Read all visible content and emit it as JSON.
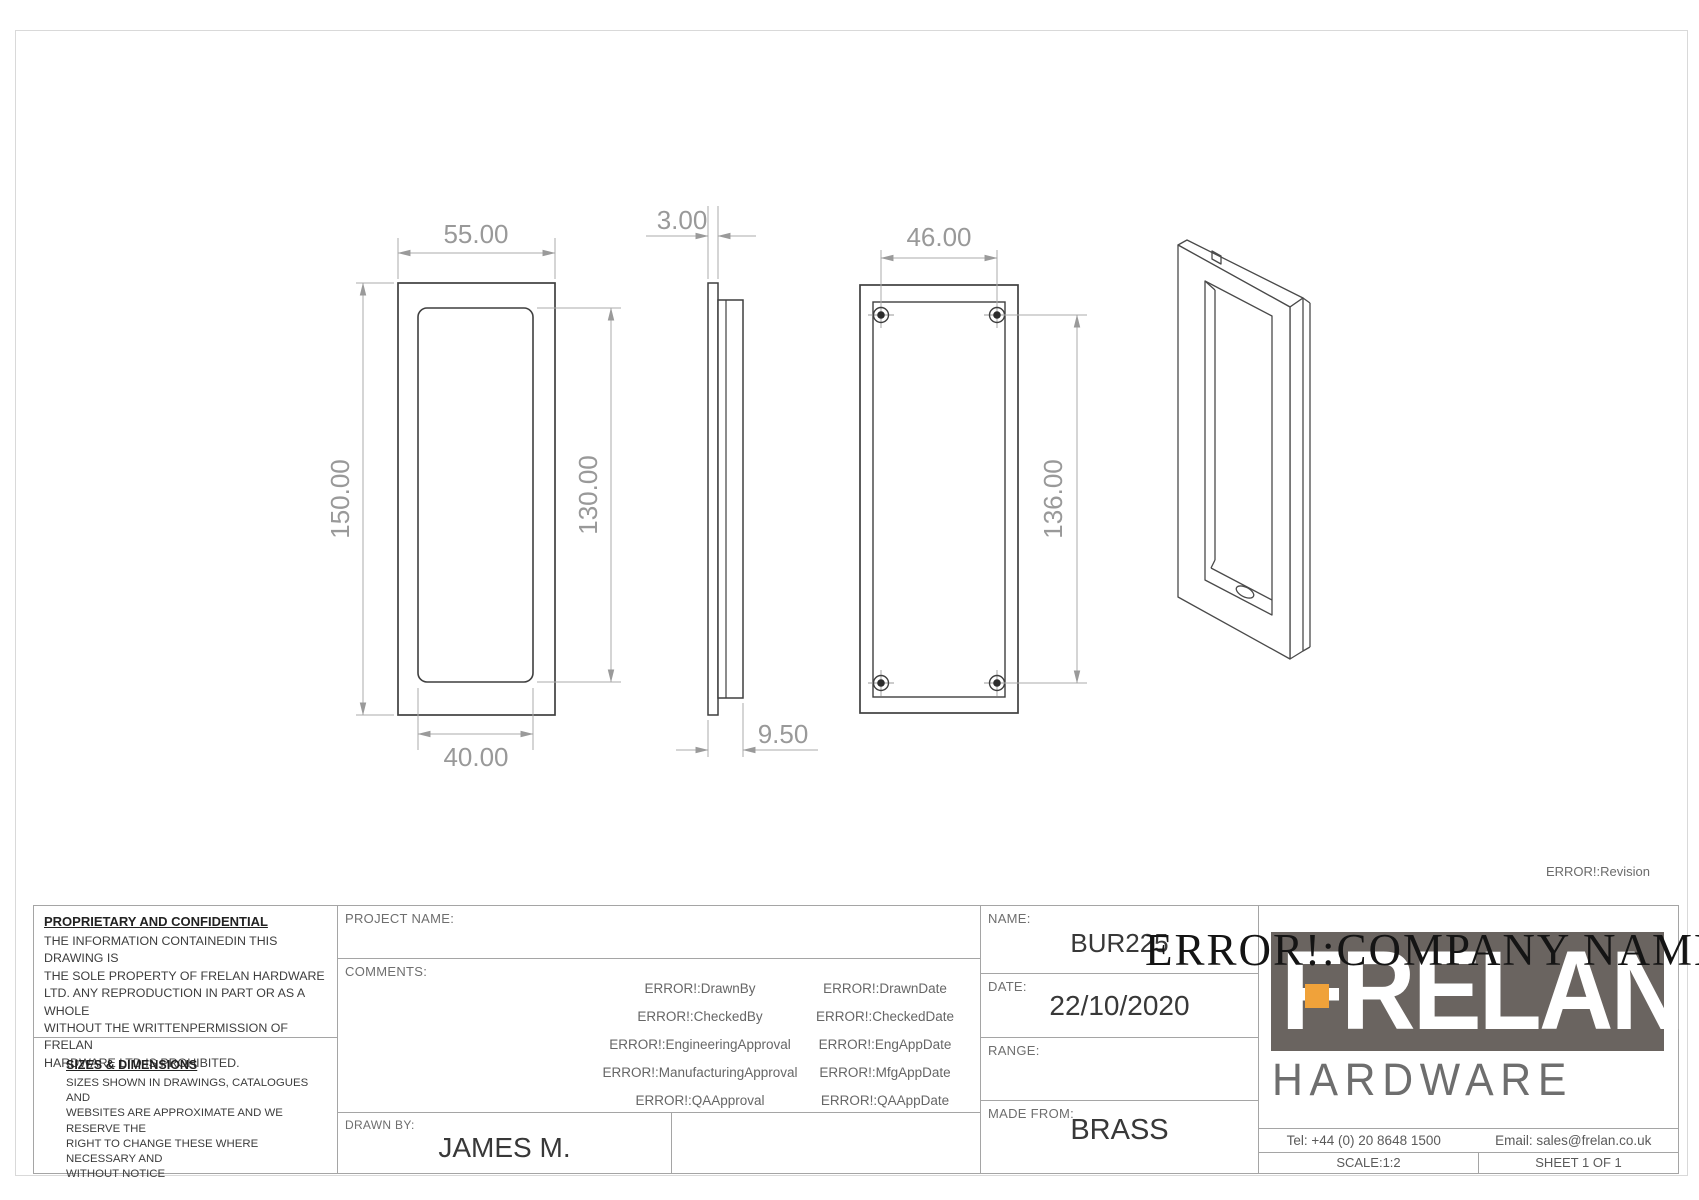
{
  "drawing": {
    "revision": "ERROR!:Revision",
    "dims": {
      "front_width": "55.00",
      "front_height": "150.00",
      "front_inner_width": "40.00",
      "front_inner_height": "130.00",
      "side_thickness": "3.00",
      "side_depth": "9.50",
      "back_hole_span_width": "46.00",
      "back_hole_span_height": "136.00"
    }
  },
  "title_block": {
    "proprietary": {
      "heading": "PROPRIETARY AND CONFIDENTIAL",
      "body": [
        "THE INFORMATION CONTAINEDIN THIS DRAWING IS",
        "THE SOLE PROPERTY OF FRELAN HARDWARE",
        "LTD. ANY REPRODUCTION IN PART OR AS A WHOLE",
        "WITHOUT THE WRITTENPERMISSION OF FRELAN",
        "HARDWARE LTD IS PROHIBITED."
      ]
    },
    "sizes": {
      "heading": "SIZES & DIMENSIONS",
      "body": [
        "SIZES SHOWN IN DRAWINGS, CATALOGUES AND",
        "WEBSITES ARE APPROXIMATE AND WE RESERVE THE",
        "RIGHT TO CHANGE THESE WHERE NECESSARY AND",
        "WITHOUT NOTICE"
      ]
    },
    "project_label": "PROJECT NAME:",
    "comments_label": "COMMENTS:",
    "approvals_left": [
      "ERROR!:DrawnBy",
      "ERROR!:CheckedBy",
      "ERROR!:EngineeringApproval",
      "ERROR!:ManufacturingApproval",
      "ERROR!:QAApproval"
    ],
    "approvals_right": [
      "ERROR!:DrawnDate",
      "ERROR!:CheckedDate",
      "ERROR!:EngAppDate",
      "ERROR!:MfgAppDate",
      "ERROR!:QAAppDate"
    ],
    "drawn_by_label": "DRAWN BY:",
    "drawn_by": "JAMES M.",
    "name_label": "NAME:",
    "name": "BUR225",
    "date_label": "DATE:",
    "date": "22/10/2020",
    "range_label": "RANGE:",
    "range": "",
    "made_from_label": "MADE FROM:",
    "made_from": "BRASS",
    "company_name_overlay": "ERROR!:COMPANY NAME",
    "logo": {
      "brand": "FRELAN",
      "sub": "HARDWARE",
      "accent_color": "#f0a23a",
      "block_color": "#6a6460"
    },
    "tel": "Tel: +44 (0) 20  8648 1500",
    "email": "Email: sales@frelan.co.uk",
    "scale": "SCALE:1:2",
    "sheet": "SHEET 1 OF 1"
  }
}
